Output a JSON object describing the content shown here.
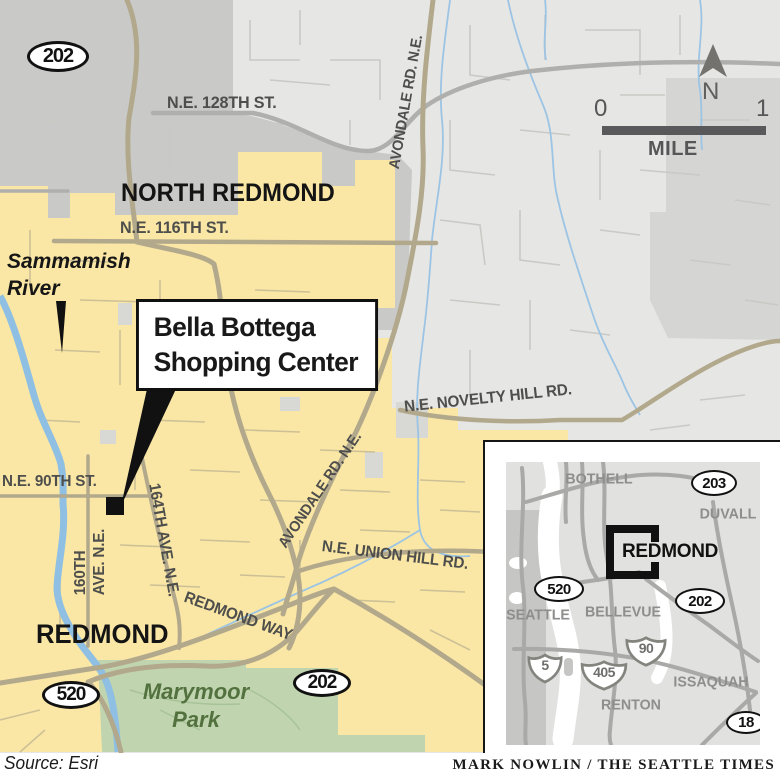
{
  "map": {
    "regions": {
      "north_redmond": "NORTH REDMOND",
      "redmond": "REDMOND"
    },
    "streets": {
      "ne_128th": "N.E. 128TH ST.",
      "ne_116th": "N.E. 116TH ST.",
      "avondale_top": "AVONDALE RD. N.E.",
      "avondale_mid": "AVONDALE RD. N.E.",
      "novelty": "N.E. NOVELTY HILL RD.",
      "union_hill": "N.E. UNION HILL RD.",
      "redmond_way": "REDMOND WAY",
      "ne_90th": "N.E. 90TH ST.",
      "ave_160th_line1": "160TH",
      "ave_160th_line2": "AVE. N.E.",
      "ave_164th": "164TH AVE. N.E."
    },
    "water": {
      "sammamish_line1": "Sammamish",
      "sammamish_line2": "River"
    },
    "park": {
      "line1": "Marymoor",
      "line2": "Park"
    },
    "callout": {
      "line1": "Bella Bottega",
      "line2": "Shopping Center"
    },
    "shields": {
      "sr202_nw": "202",
      "sr520": "520",
      "sr202_s": "202"
    },
    "scale": {
      "zero": "0",
      "one": "1",
      "unit": "MILE",
      "north": "N"
    }
  },
  "inset": {
    "cities": {
      "bothell": "BOTHELL",
      "duvall": "DUVALL",
      "seattle": "SEATTLE",
      "bellevue": "BELLEVUE",
      "issaquah": "ISSAQUAH",
      "renton": "RENTON"
    },
    "highlight": "REDMOND",
    "shields": {
      "sr203": "203",
      "sr520": "520",
      "sr202": "202",
      "sr18": "18",
      "i5": "5",
      "i405": "405",
      "i90": "90"
    }
  },
  "footer": {
    "source": "Source: Esri",
    "credit": "MARK NOWLIN / THE SEATTLE TIMES"
  },
  "colors": {
    "city_fill": "#FAE7A5",
    "base_gray": "#E6E6E4",
    "medium_gray": "#C9C9C7",
    "park_green": "#C0D5AF",
    "park_text": "#52713E",
    "water_blue": "#8FBFE2",
    "road_tan": "#B2A88C",
    "road_gray": "#AFAFAD",
    "marker_black": "#111111"
  }
}
